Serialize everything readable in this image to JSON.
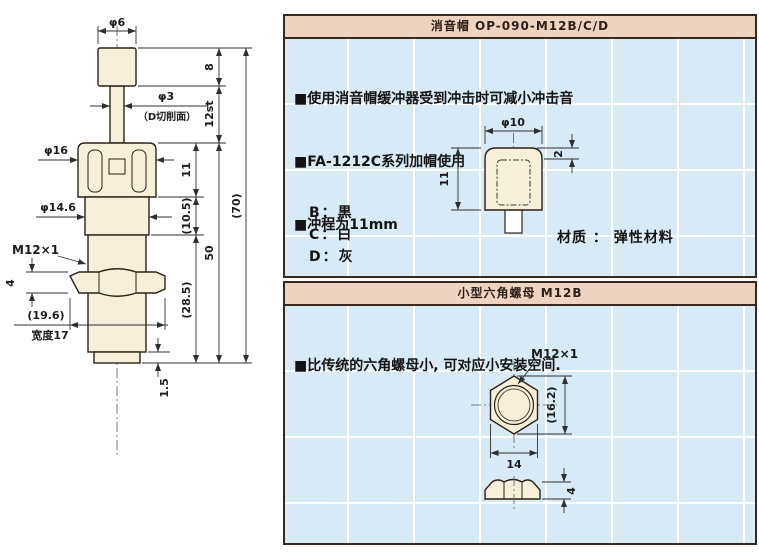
{
  "theme": {
    "header_bg": "#edd4c2",
    "panel_bg": "#d8eaf6",
    "grid_line": "#ffffff",
    "border": "#39281e",
    "part_fill": "#f6efd9",
    "line_color": "#2f2f2f"
  },
  "left_drawing": {
    "dims": {
      "dia6": "φ6",
      "h8": "8",
      "dia3": "φ3",
      "d_cut": "（D切削面）",
      "stroke12": "12st",
      "dia16": "φ16",
      "h11": "11",
      "dia14_6": "φ14.6",
      "h10_5": "(10.5)",
      "thread": "M12×1",
      "nut_t4": "4",
      "w19_6": "(19.6)",
      "width17": "宽度17",
      "h50": "50",
      "h28_5": "(28.5)",
      "h70": "(70)",
      "h1_5": "1.5"
    }
  },
  "silencer_panel": {
    "title": "消音帽 OP-090-M12B/C/D",
    "bullets": [
      "■使用消音帽缓冲器受到冲击时可减小冲击音",
      "■FA-1212C系列加帽使用",
      "■冲程为11mm"
    ],
    "color_options": [
      "B：黒",
      "C：白",
      "D：灰"
    ],
    "material": "材质 ： 弹性材料",
    "dims": {
      "dia10": "φ10",
      "h11": "11",
      "r2": "2"
    }
  },
  "nut_panel": {
    "title": "小型六角螺母 M12B",
    "bullets": [
      "■比传统的六角螺母小, 可对应小安装空间."
    ],
    "dims": {
      "thread": "M12×1",
      "h16_2": "(16.2)",
      "w14": "14",
      "t4": "4"
    }
  }
}
